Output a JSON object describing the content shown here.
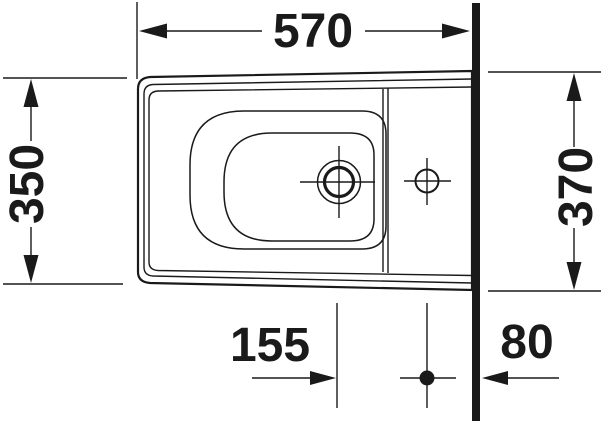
{
  "drawing": {
    "title": "bidet-top-view-dimension-drawing",
    "background_color": "#ffffff",
    "line_color": "#1a1a1a",
    "dimensions": {
      "overall_length": {
        "value": "570",
        "orientation": "horizontal",
        "position": "top"
      },
      "front_width": {
        "value": "350",
        "orientation": "vertical",
        "position": "left"
      },
      "wall_width": {
        "value": "370",
        "orientation": "vertical",
        "position": "right"
      },
      "drain_to_tap_offset": {
        "value": "155",
        "orientation": "horizontal",
        "position": "bottom-center"
      },
      "tap_to_wall_offset": {
        "value": "80",
        "orientation": "horizontal",
        "position": "bottom-right"
      }
    }
  }
}
